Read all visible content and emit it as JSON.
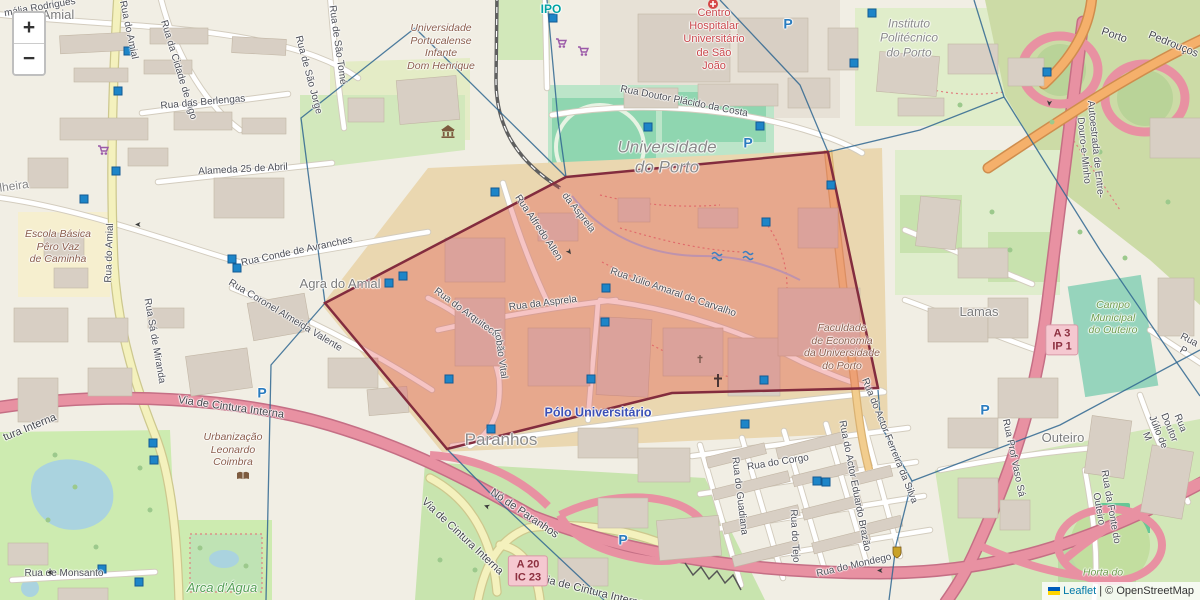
{
  "zoom_control": {
    "zoom_in": "+",
    "zoom_out": "−"
  },
  "attribution": {
    "leaflet_link": "Leaflet",
    "separator": "|",
    "osm_credit": "© OpenStreetMap"
  },
  "badges": [
    {
      "lines": "A 3\nIP 1",
      "x": 1062,
      "y": 340
    },
    {
      "lines": "A 20\nIC 23",
      "x": 528,
      "y": 571
    }
  ],
  "overlay": {
    "polygon": {
      "points": [
        [
          566,
          177
        ],
        [
          828,
          152
        ],
        [
          878,
          388
        ],
        [
          672,
          393
        ],
        [
          447,
          449
        ],
        [
          325,
          303
        ]
      ],
      "fill": "#e03c3c",
      "fill_opacity": 0.3,
      "stroke": "#832c3e"
    },
    "voronoi": {
      "color": "#2f6690",
      "lines": [
        [
          [
            547,
            0
          ],
          [
            558,
            120
          ],
          [
            566,
            177
          ]
        ],
        [
          [
            415,
            28
          ],
          [
            566,
            177
          ]
        ],
        [
          [
            415,
            28
          ],
          [
            301,
            118
          ],
          [
            325,
            303
          ]
        ],
        [
          [
            325,
            303
          ],
          [
            271,
            365
          ],
          [
            266,
            600
          ]
        ],
        [
          [
            447,
            449
          ],
          [
            489,
            492
          ],
          [
            604,
            600
          ]
        ],
        [
          [
            878,
            390
          ],
          [
            881,
            426
          ],
          [
            912,
            481
          ]
        ],
        [
          [
            912,
            481
          ],
          [
            1060,
            425
          ],
          [
            1200,
            350
          ]
        ],
        [
          [
            1004,
            97
          ],
          [
            1100,
            250
          ],
          [
            1173,
            357
          ],
          [
            1200,
            396
          ]
        ],
        [
          [
            974,
            0
          ],
          [
            1004,
            97
          ]
        ],
        [
          [
            1004,
            97
          ],
          [
            920,
            130
          ],
          [
            828,
            152
          ]
        ],
        [
          [
            720,
            0
          ],
          [
            800,
            85
          ],
          [
            828,
            152
          ]
        ],
        [
          [
            912,
            481
          ],
          [
            896,
            545
          ],
          [
            889,
            600
          ]
        ]
      ]
    },
    "markers": {
      "color": "#1d85c8",
      "stroke": "#135a93",
      "positions": [
        [
          128,
          51
        ],
        [
          118,
          91
        ],
        [
          116,
          171
        ],
        [
          84,
          199
        ],
        [
          232,
          259
        ],
        [
          237,
          268
        ],
        [
          389,
          283
        ],
        [
          403,
          276
        ],
        [
          495,
          192
        ],
        [
          606,
          288
        ],
        [
          449,
          379
        ],
        [
          591,
          379
        ],
        [
          605,
          322
        ],
        [
          153,
          443
        ],
        [
          154,
          460
        ],
        [
          102,
          569
        ],
        [
          139,
          582
        ],
        [
          745,
          424
        ],
        [
          817,
          481
        ],
        [
          826,
          482
        ],
        [
          872,
          13
        ],
        [
          854,
          63
        ],
        [
          553,
          18
        ],
        [
          491,
          429
        ],
        [
          1047,
          72
        ],
        [
          648,
          127
        ],
        [
          760,
          126
        ],
        [
          831,
          185
        ],
        [
          766,
          222
        ],
        [
          764,
          380
        ]
      ]
    }
  },
  "icons": [
    {
      "name": "museum",
      "x": 448,
      "y": 132
    },
    {
      "name": "book",
      "x": 243,
      "y": 476
    },
    {
      "name": "shield",
      "x": 897,
      "y": 552
    },
    {
      "name": "cross",
      "x": 718,
      "y": 381
    },
    {
      "name": "cross-sm",
      "x": 700,
      "y": 359
    },
    {
      "name": "fountain",
      "x": 717,
      "y": 256
    },
    {
      "name": "fountain",
      "x": 748,
      "y": 255
    },
    {
      "name": "hospital-dot",
      "x": 713,
      "y": 4
    },
    {
      "name": "cart",
      "x": 561,
      "y": 43
    },
    {
      "name": "cart",
      "x": 583,
      "y": 51
    },
    {
      "name": "cart",
      "x": 103,
      "y": 150
    }
  ],
  "map_labels": [
    {
      "text": "mália Rodrigues",
      "x": 40,
      "y": 8,
      "rot": -10,
      "cls": "street"
    },
    {
      "text": "Amial",
      "x": 58,
      "y": 15,
      "cls": "place"
    },
    {
      "text": "Rua do Amial",
      "x": 128,
      "y": 30,
      "rot": 78,
      "cls": "street"
    },
    {
      "text": "Rua da Cidade de Vigo",
      "x": 178,
      "y": 70,
      "rot": 73,
      "cls": "street"
    },
    {
      "text": "Rua das Berlengas",
      "x": 203,
      "y": 103,
      "rot": -5,
      "cls": "street"
    },
    {
      "text": "Alameda 25 de Abril",
      "x": 243,
      "y": 170,
      "rot": -3,
      "cls": "street"
    },
    {
      "text": "lheira",
      "x": 14,
      "y": 186,
      "rot": -8,
      "cls": "place-sm"
    },
    {
      "text": "Escola Básica\nPêro Vaz\nde Caminha",
      "x": 58,
      "y": 247,
      "cls": "poi-brown"
    },
    {
      "text": "Rua do Amial",
      "x": 110,
      "y": 253,
      "rot": -88,
      "cls": "street"
    },
    {
      "text": "Rua Sá de Miranda",
      "x": 154,
      "y": 341,
      "rot": 80,
      "cls": "street"
    },
    {
      "text": "Rua Conde de Avranches",
      "x": 297,
      "y": 252,
      "rot": -12,
      "cls": "street"
    },
    {
      "text": "Agra do Amial",
      "x": 340,
      "y": 284,
      "cls": "place"
    },
    {
      "text": "Rua Coronel Almeida Valente",
      "x": 285,
      "y": 316,
      "rot": 31,
      "cls": "street"
    },
    {
      "text": "Rua de Monsanto",
      "x": 64,
      "y": 574,
      "cls": "street"
    },
    {
      "text": "Urbanização\nLeonardo\nCoimbra",
      "x": 233,
      "y": 450,
      "cls": "poi-brown"
    },
    {
      "text": "Arca d'Água",
      "x": 222,
      "y": 588,
      "cls": "poi-green-lg"
    },
    {
      "text": "Via de Cintura Interna",
      "x": 231,
      "y": 408,
      "rot": 8,
      "cls": "street-lg"
    },
    {
      "text": "tura Interna",
      "x": 30,
      "y": 428,
      "rot": -22,
      "cls": "street-lg"
    },
    {
      "text": "Via de Cintura Interna",
      "x": 462,
      "y": 537,
      "rot": 43,
      "cls": "street-lg"
    },
    {
      "text": "Nó de Paranhos",
      "x": 524,
      "y": 514,
      "rot": 34,
      "cls": "street-lg"
    },
    {
      "text": "Via de Cintura Interna",
      "x": 592,
      "y": 592,
      "rot": 14,
      "cls": "street-lg"
    },
    {
      "text": "Paranhos",
      "x": 501,
      "y": 440,
      "cls": "place-lg"
    },
    {
      "text": "Pólo Universitário",
      "x": 598,
      "y": 413,
      "cls": "poi-blue"
    },
    {
      "text": "Universidade\ndo Porto",
      "x": 667,
      "y": 158,
      "cls": "place-italic-lg"
    },
    {
      "text": "IPO",
      "x": 551,
      "y": 9,
      "cls": "poi-teal"
    },
    {
      "text": "Centro\nHospitalar\nUniversitário\nde São\nJoão",
      "x": 714,
      "y": 40,
      "cls": "poi-red"
    },
    {
      "text": "Rua Doutor Plácido da Costa",
      "x": 684,
      "y": 102,
      "rot": 11,
      "cls": "street"
    },
    {
      "text": "Universidade\nPortucalense\nInfante\nDom Henrique",
      "x": 441,
      "y": 47,
      "cls": "poi-brown"
    },
    {
      "text": "Rua de São Tomé",
      "x": 337,
      "y": 45,
      "rot": 82,
      "cls": "street"
    },
    {
      "text": "Rua de São Jorge",
      "x": 308,
      "y": 75,
      "rot": 75,
      "cls": "street"
    },
    {
      "text": "Instituto\nPolitécnico\ndo Porto",
      "x": 909,
      "y": 38,
      "cls": "place-italic"
    },
    {
      "text": "Porto",
      "x": 1114,
      "y": 36,
      "rot": 19,
      "cls": "street-lg"
    },
    {
      "text": "Pedrouços",
      "x": 1173,
      "y": 45,
      "rot": 22,
      "cls": "street-lg"
    },
    {
      "text": "Autoestrada de Entre-Douro-e-Minho",
      "x": 1089,
      "y": 150,
      "rot": 84,
      "cls": "street"
    },
    {
      "text": "Lamas",
      "x": 979,
      "y": 312,
      "cls": "place"
    },
    {
      "text": "Campo\nMunicipal\ndo Outeiro",
      "x": 1113,
      "y": 318,
      "cls": "poi-green"
    },
    {
      "text": "Rua P",
      "x": 1186,
      "y": 346,
      "rot": 28,
      "cls": "street"
    },
    {
      "text": "Outeiro",
      "x": 1063,
      "y": 438,
      "cls": "place"
    },
    {
      "text": "Rua Prof Vaso Sá",
      "x": 1013,
      "y": 458,
      "rot": 78,
      "cls": "street"
    },
    {
      "text": "Rua Doutor Júlio de M",
      "x": 1163,
      "y": 430,
      "rot": 68,
      "cls": "street"
    },
    {
      "text": "Rua da Fonte do Outeiro",
      "x": 1104,
      "y": 508,
      "rot": 80,
      "cls": "street"
    },
    {
      "text": "Horta do",
      "x": 1103,
      "y": 573,
      "cls": "poi-green"
    },
    {
      "text": "Rua do Corgo",
      "x": 778,
      "y": 463,
      "rot": -9,
      "cls": "street"
    },
    {
      "text": "Rua do Guadiana",
      "x": 739,
      "y": 496,
      "rot": 83,
      "cls": "street"
    },
    {
      "text": "Rua do Tejo",
      "x": 794,
      "y": 536,
      "rot": 87,
      "cls": "street"
    },
    {
      "text": "Rua do Actor Eduardo Brazão",
      "x": 854,
      "y": 486,
      "rot": 79,
      "cls": "street"
    },
    {
      "text": "Rua do Mondego",
      "x": 854,
      "y": 566,
      "rot": -13,
      "cls": "street"
    },
    {
      "text": "Rua do Actor Ferreira da Silva",
      "x": 889,
      "y": 441,
      "rot": 68,
      "cls": "street"
    },
    {
      "text": "Rua Alfredo Allen",
      "x": 538,
      "y": 228,
      "rot": 56,
      "cls": "street"
    },
    {
      "text": "Rua da Asprela",
      "x": 543,
      "y": 304,
      "rot": -7,
      "cls": "street"
    },
    {
      "text": "da Asprela",
      "x": 578,
      "y": 213,
      "rot": 52,
      "cls": "street"
    },
    {
      "text": "Rua do Arquitecto",
      "x": 467,
      "y": 314,
      "rot": 36,
      "cls": "street"
    },
    {
      "text": "Lobão Vital",
      "x": 500,
      "y": 354,
      "rot": 82,
      "cls": "street"
    },
    {
      "text": "Rua Júlio Amaral de Carvalho",
      "x": 673,
      "y": 293,
      "rot": 19,
      "cls": "street"
    },
    {
      "text": "Faculdade\nde Economia\nda Universidade\ndo Porto",
      "x": 842,
      "y": 347,
      "cls": "poi-brown"
    },
    {
      "text": "P",
      "x": 788,
      "y": 24,
      "cls": "parking"
    },
    {
      "text": "P",
      "x": 748,
      "y": 143,
      "cls": "parking"
    },
    {
      "text": "P",
      "x": 985,
      "y": 410,
      "cls": "parking"
    },
    {
      "text": "P",
      "x": 262,
      "y": 393,
      "cls": "parking"
    },
    {
      "text": "P",
      "x": 623,
      "y": 540,
      "cls": "parking"
    },
    {
      "text": "➤",
      "x": 138,
      "y": 224,
      "rot": 180,
      "cls": "arrow"
    },
    {
      "text": "➤",
      "x": 569,
      "y": 252,
      "rot": 55,
      "cls": "arrow"
    },
    {
      "text": "➤",
      "x": 50,
      "y": 572,
      "rot": 180,
      "cls": "arrow"
    },
    {
      "text": "➤",
      "x": 487,
      "y": 506,
      "rot": 200,
      "cls": "arrow"
    },
    {
      "text": "➤",
      "x": 880,
      "y": 570,
      "rot": 180,
      "cls": "arrow"
    },
    {
      "text": "➤",
      "x": 1049,
      "y": 103,
      "rot": 95,
      "cls": "arrow"
    }
  ]
}
